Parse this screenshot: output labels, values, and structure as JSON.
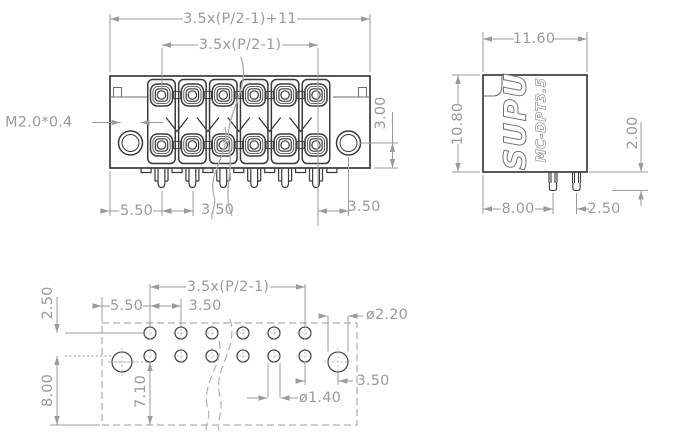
{
  "drawing_type": "terminal-block connector engineering drawing",
  "colors": {
    "background": "#ffffff",
    "outline_dark": "#3b3b3d",
    "outline_medium": "#6e6e71",
    "dimension_gray": "#9b9b9e"
  },
  "front": {
    "overall": "3.5x(P/2-1)+11",
    "span": "3.5x(P/2-1)",
    "thread": "M2.0*0.4",
    "screw_offset": "3.00",
    "edge_pin": "5.50",
    "pitch": "3.50",
    "screw_pitch": "3.50"
  },
  "side": {
    "width": "11.60",
    "height": "10.80",
    "brand": "SUPU",
    "model": "MC-DPT3.5",
    "pin_len": "2.00",
    "row_offset": "8.00",
    "row_pitch": "2.50"
  },
  "fp": {
    "span": "3.5x(P/2-1)",
    "rows": "2.50",
    "edge_col": "5.50",
    "pitch": "3.50",
    "mount_dia": "ø2.20",
    "bottom": "8.00",
    "mount_bottom": "7.10",
    "mount_offset": "3.50",
    "pin_dia": "ø1.40"
  }
}
